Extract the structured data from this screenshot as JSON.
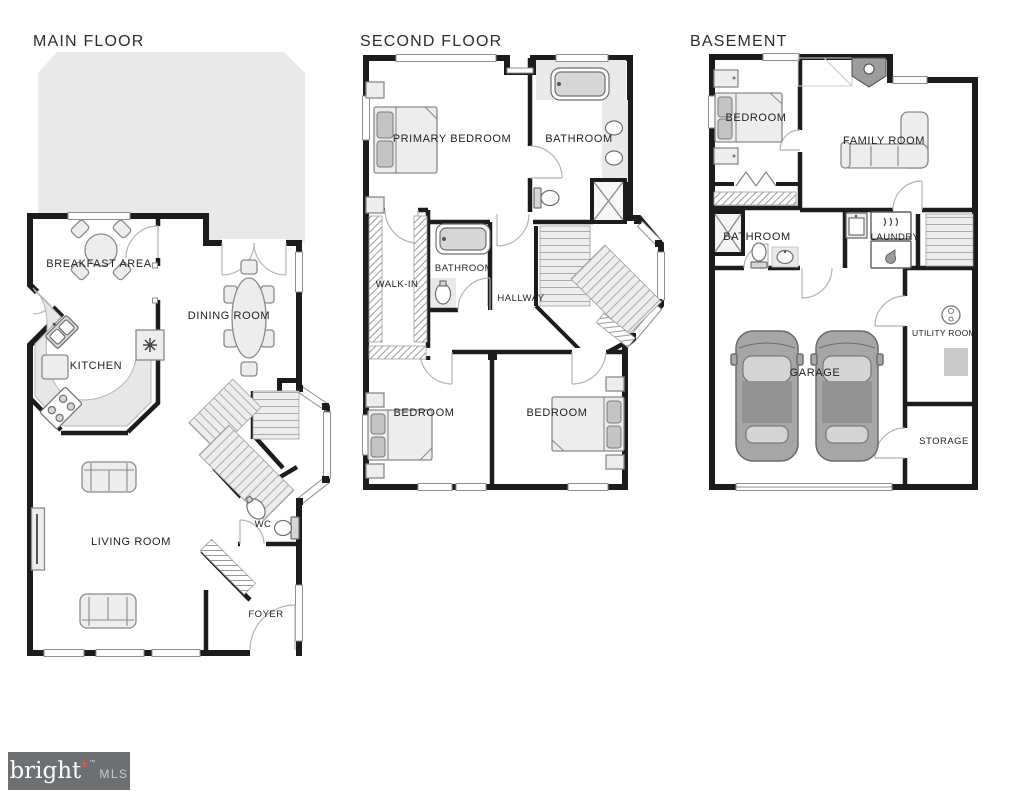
{
  "page": {
    "background": "#ffffff"
  },
  "colors": {
    "wall": "#1c1c1c",
    "deck_tint": "#e9e9e9",
    "furniture_fill": "#ededed",
    "logo_bg": "#6c7072",
    "logo_star": "#e0563c",
    "logo_text": "#fafafa",
    "logo_mls": "#c9cccd"
  },
  "floors": [
    {
      "id": "main-floor",
      "title": "MAIN FLOOR",
      "rooms": [
        {
          "id": "breakfast-area",
          "label": "BREAKFAST AREA"
        },
        {
          "id": "kitchen",
          "label": "KITCHEN"
        },
        {
          "id": "dining-room",
          "label": "DINING ROOM"
        },
        {
          "id": "living-room",
          "label": "LIVING ROOM"
        },
        {
          "id": "wc",
          "label": "WC"
        },
        {
          "id": "foyer",
          "label": "FOYER"
        }
      ]
    },
    {
      "id": "second-floor",
      "title": "SECOND FLOOR",
      "rooms": [
        {
          "id": "primary-bedroom",
          "label": "PRIMARY BEDROOM"
        },
        {
          "id": "bathroom-ensuite",
          "label": "BATHROOM"
        },
        {
          "id": "walk-in",
          "label": "WALK-IN"
        },
        {
          "id": "bathroom-hall",
          "label": "BATHROOM"
        },
        {
          "id": "hallway",
          "label": "HALLWAY"
        },
        {
          "id": "bedroom-left",
          "label": "BEDROOM"
        },
        {
          "id": "bedroom-right",
          "label": "BEDROOM"
        }
      ]
    },
    {
      "id": "basement",
      "title": "BASEMENT",
      "rooms": [
        {
          "id": "bedroom",
          "label": "BEDROOM"
        },
        {
          "id": "family-room",
          "label": "FAMILY ROOM"
        },
        {
          "id": "bathroom",
          "label": "BATHROOM"
        },
        {
          "id": "laundry",
          "label": "LAUNDRY"
        },
        {
          "id": "garage",
          "label": "GARAGE"
        },
        {
          "id": "utility-room",
          "label": "UTILITY ROOM"
        },
        {
          "id": "storage",
          "label": "STORAGE"
        }
      ]
    }
  ],
  "logo": {
    "brand": "bright",
    "star": "✦",
    "tm": "™",
    "suffix": "MLS"
  }
}
